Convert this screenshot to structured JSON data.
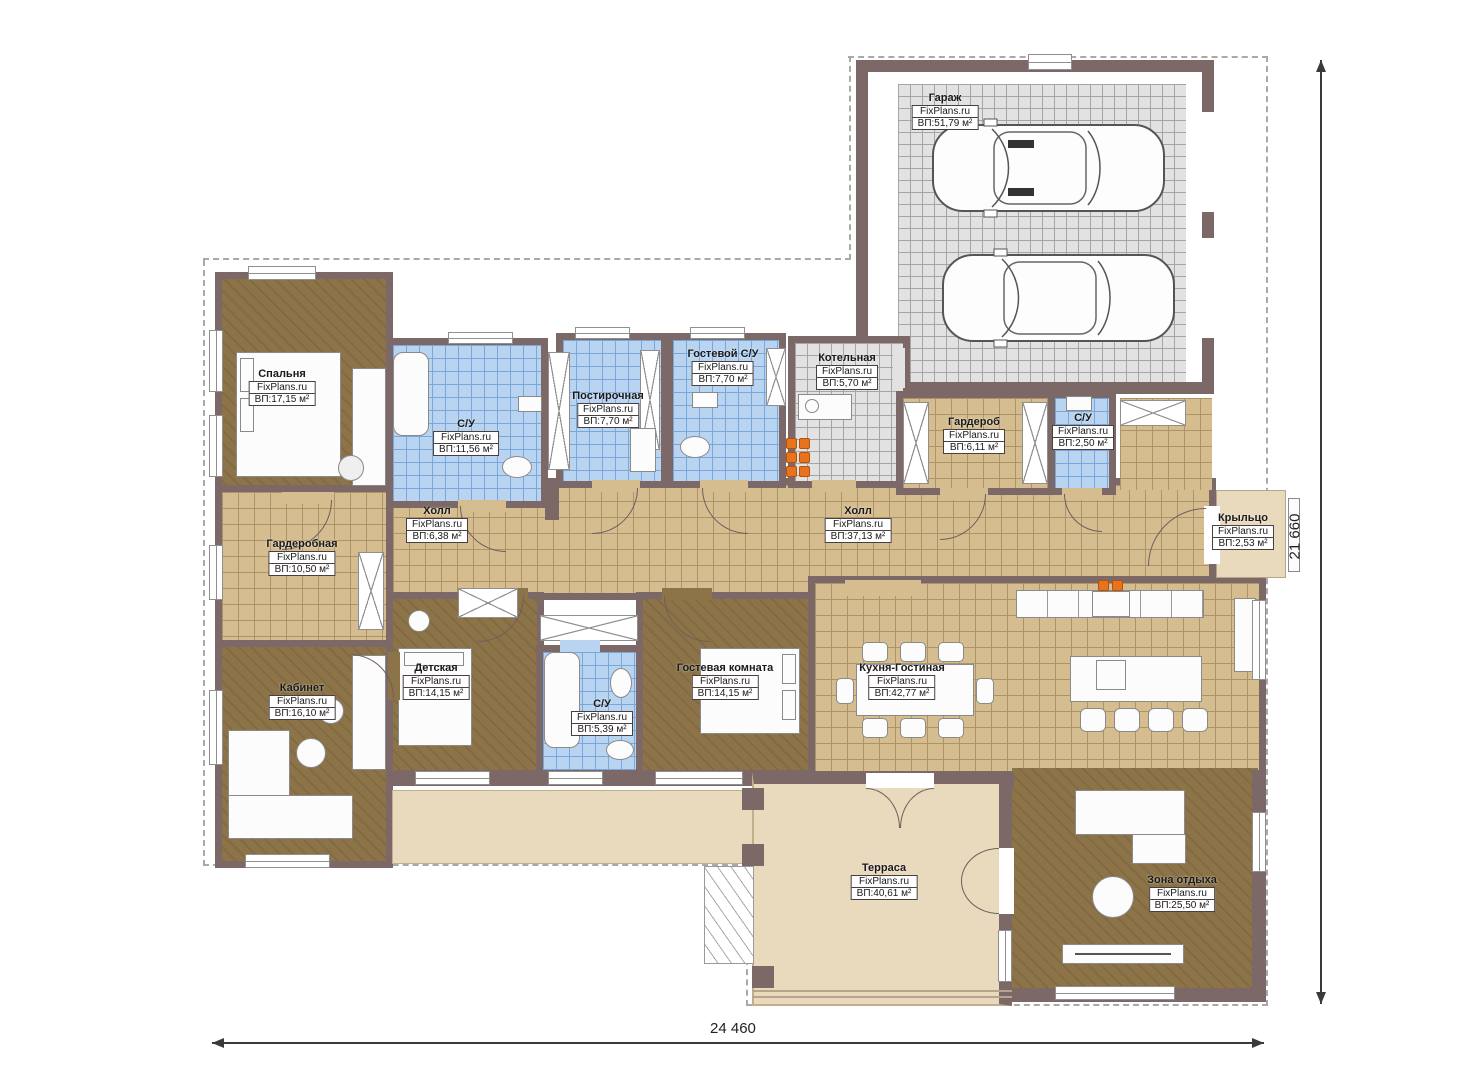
{
  "plan": {
    "brand": "FixPlans.ru",
    "dim_bottom": "24 460",
    "dim_right": "21 660"
  },
  "rooms": [
    {
      "name": "Спальня",
      "area": "ВП:17,15 м²"
    },
    {
      "name": "С/У",
      "area": "ВП:11,56 м²"
    },
    {
      "name": "Постирочная",
      "area": "ВП:7,70 м²"
    },
    {
      "name": "Гостевой С/У",
      "area": "ВП:7,70 м²"
    },
    {
      "name": "Котельная",
      "area": "ВП:5,70 м²"
    },
    {
      "name": "Гараж",
      "area": "ВП:51,79 м²"
    },
    {
      "name": "Гардероб",
      "area": "ВП:6,11 м²"
    },
    {
      "name": "С/У",
      "area": "ВП:2,50 м²"
    },
    {
      "name": "Холл",
      "area": "ВП:6,38 м²"
    },
    {
      "name": "Холл",
      "area": "ВП:37,13 м²"
    },
    {
      "name": "Гардеробная",
      "area": "ВП:10,50 м²"
    },
    {
      "name": "Крыльцо",
      "area": "ВП:2,53 м²"
    },
    {
      "name": "Кабинет",
      "area": "ВП:16,10 м²"
    },
    {
      "name": "Детская",
      "area": "ВП:14,15 м²"
    },
    {
      "name": "С/У",
      "area": "ВП:5,39 м²"
    },
    {
      "name": "Гостевая комната",
      "area": "ВП:14,15 м²"
    },
    {
      "name": "Кухня-Гостиная",
      "area": "ВП:42,77 м²"
    },
    {
      "name": "Терраса",
      "area": "ВП:40,61 м²"
    },
    {
      "name": "Зона отдыха",
      "area": "ВП:25,50 м²"
    }
  ]
}
